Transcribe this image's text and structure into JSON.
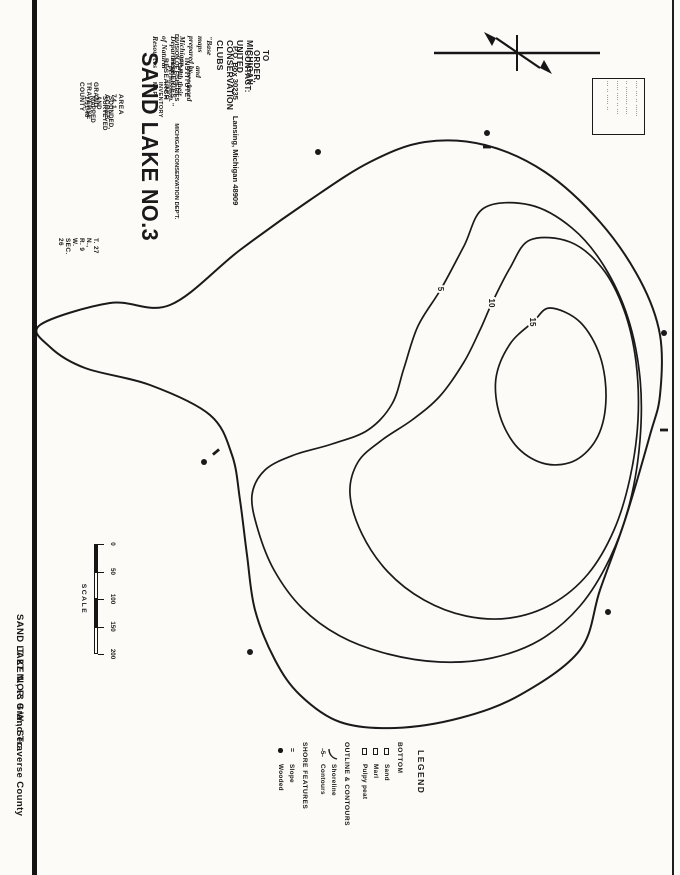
{
  "colors": {
    "ink": "#1a1a1a",
    "paper": "#fcfbf8"
  },
  "caption": {
    "lake": "SAND LAKE NO.3  Grand Traverse County",
    "township": "T. 27 N.,  R. 9 W.,  Sec."
  },
  "order_block": {
    "line1": "TO ORDER, CONTACT:",
    "line2": "MICHIGAN UNITED CONSERVATION CLUBS",
    "line3a": "P.O. Box 30235",
    "line3b": "Lansing, Michigan 48909",
    "quote1": "\"Base maps prepared by Michigan Department of Natural Resources",
    "quote2": "and reproduced with their permission.\""
  },
  "title_block": {
    "institute": "INSTITUTE FOR FISHERIES RESEARCH",
    "division": "DIVISION OF FISHERIES",
    "department": "MICHIGAN CONSERVATION DEP'T.",
    "map_type": "LAKE INVENTORY MAP",
    "lake_name": "SAND LAKE NO.3",
    "area": "AREA  74.1 ACRES",
    "surveyed": "SOUNDED, SURVEYED AND MAPPED   1/31/48",
    "county": "GRAND TRAVERSE COUNTY",
    "township": "T. 27 N.,  R. 9 W.   SEC. 26"
  },
  "stamp": {
    "lines": [
      "···· ··· ·· ······",
      "·· ········· ····",
      "····· ···· ·· ···",
      "··· ·· ····· ··"
    ]
  },
  "scale": {
    "label": "SCALE",
    "ticks": [
      "0",
      "50",
      "100",
      "150",
      "200"
    ]
  },
  "legend": {
    "title": "LEGEND",
    "sections": [
      {
        "heading": "BOTTOM",
        "items": [
          {
            "symbol": "square",
            "label": "Sand"
          },
          {
            "symbol": "square",
            "label": "Marl"
          },
          {
            "symbol": "square",
            "label": "Pulpy peat"
          }
        ]
      },
      {
        "heading": "OUTLINE & CONTOURS",
        "items": [
          {
            "symbol": "shoreline",
            "label": "Shoreline"
          },
          {
            "symbol": "contour",
            "label": "Contours"
          }
        ]
      },
      {
        "heading": "SHORE FEATURES",
        "items": [
          {
            "symbol": "slope",
            "label": "Slope"
          },
          {
            "symbol": "wooded",
            "label": "Wooded"
          }
        ]
      }
    ]
  },
  "map": {
    "contours": [
      {
        "depth_label": "",
        "stroke_w": 2.0,
        "points": [
          [
            325,
            640
          ],
          [
            303,
            570
          ],
          [
            305,
            510
          ],
          [
            250,
            440
          ],
          [
            200,
            370
          ],
          [
            162,
            310
          ],
          [
            142,
            255
          ],
          [
            145,
            195
          ],
          [
            172,
            135
          ],
          [
            222,
            80
          ],
          [
            280,
            40
          ],
          [
            335,
            20
          ],
          [
            395,
            20
          ],
          [
            435,
            30
          ],
          [
            520,
            55
          ],
          [
            590,
            80
          ],
          [
            650,
            100
          ],
          [
            695,
            160
          ],
          [
            718,
            220
          ],
          [
            728,
            285
          ],
          [
            722,
            340
          ],
          [
            695,
            380
          ],
          [
            660,
            405
          ],
          [
            610,
            425
          ],
          [
            555,
            433
          ],
          [
            500,
            440
          ],
          [
            455,
            448
          ],
          [
            415,
            470
          ],
          [
            385,
            530
          ],
          [
            368,
            595
          ],
          [
            347,
            630
          ]
        ]
      },
      {
        "depth_label": "5",
        "label_pos": [
          289,
          239
        ],
        "stroke_w": 1.7,
        "points": [
          [
            208,
            196
          ],
          [
            205,
            150
          ],
          [
            228,
            108
          ],
          [
            266,
            76
          ],
          [
            318,
            52
          ],
          [
            378,
            40
          ],
          [
            440,
            40
          ],
          [
            502,
            50
          ],
          [
            558,
            70
          ],
          [
            606,
            100
          ],
          [
            640,
            140
          ],
          [
            658,
            188
          ],
          [
            662,
            240
          ],
          [
            654,
            292
          ],
          [
            636,
            340
          ],
          [
            608,
            378
          ],
          [
            570,
            406
          ],
          [
            530,
            422
          ],
          [
            495,
            428
          ],
          [
            470,
            415
          ],
          [
            455,
            386
          ],
          [
            444,
            348
          ],
          [
            430,
            312
          ],
          [
            404,
            288
          ],
          [
            368,
            276
          ],
          [
            326,
            262
          ],
          [
            289,
            239
          ],
          [
            246,
            216
          ]
        ]
      },
      {
        "depth_label": "10",
        "label_pos": [
          303,
          188
        ],
        "stroke_w": 1.7,
        "points": [
          [
            240,
            150
          ],
          [
            242,
            110
          ],
          [
            268,
            78
          ],
          [
            310,
            56
          ],
          [
            362,
            44
          ],
          [
            420,
            42
          ],
          [
            478,
            50
          ],
          [
            530,
            66
          ],
          [
            574,
            92
          ],
          [
            604,
            128
          ],
          [
            618,
            170
          ],
          [
            616,
            214
          ],
          [
            600,
            256
          ],
          [
            572,
            292
          ],
          [
            534,
            318
          ],
          [
            494,
            330
          ],
          [
            462,
            322
          ],
          [
            440,
            298
          ],
          [
            420,
            268
          ],
          [
            396,
            240
          ],
          [
            362,
            216
          ],
          [
            330,
            200
          ],
          [
            303,
            188
          ],
          [
            268,
            170
          ]
        ]
      },
      {
        "depth_label": "15",
        "label_pos": [
          322,
          147
        ],
        "stroke_w": 1.7,
        "points": [
          [
            308,
            130
          ],
          [
            322,
            100
          ],
          [
            356,
            80
          ],
          [
            398,
            74
          ],
          [
            436,
            82
          ],
          [
            460,
            104
          ],
          [
            464,
            134
          ],
          [
            448,
            162
          ],
          [
            416,
            180
          ],
          [
            378,
            184
          ],
          [
            344,
            170
          ],
          [
            322,
            147
          ]
        ]
      }
    ],
    "wooded_dots": [
      [
        462,
        476
      ],
      [
        152,
        362
      ],
      [
        133,
        193
      ],
      [
        333,
        16
      ],
      [
        612,
        72
      ],
      [
        652,
        430
      ]
    ],
    "slope_dashes": [
      [
        452,
        464,
        50
      ],
      [
        147,
        193,
        90
      ],
      [
        430,
        16,
        90
      ]
    ]
  }
}
